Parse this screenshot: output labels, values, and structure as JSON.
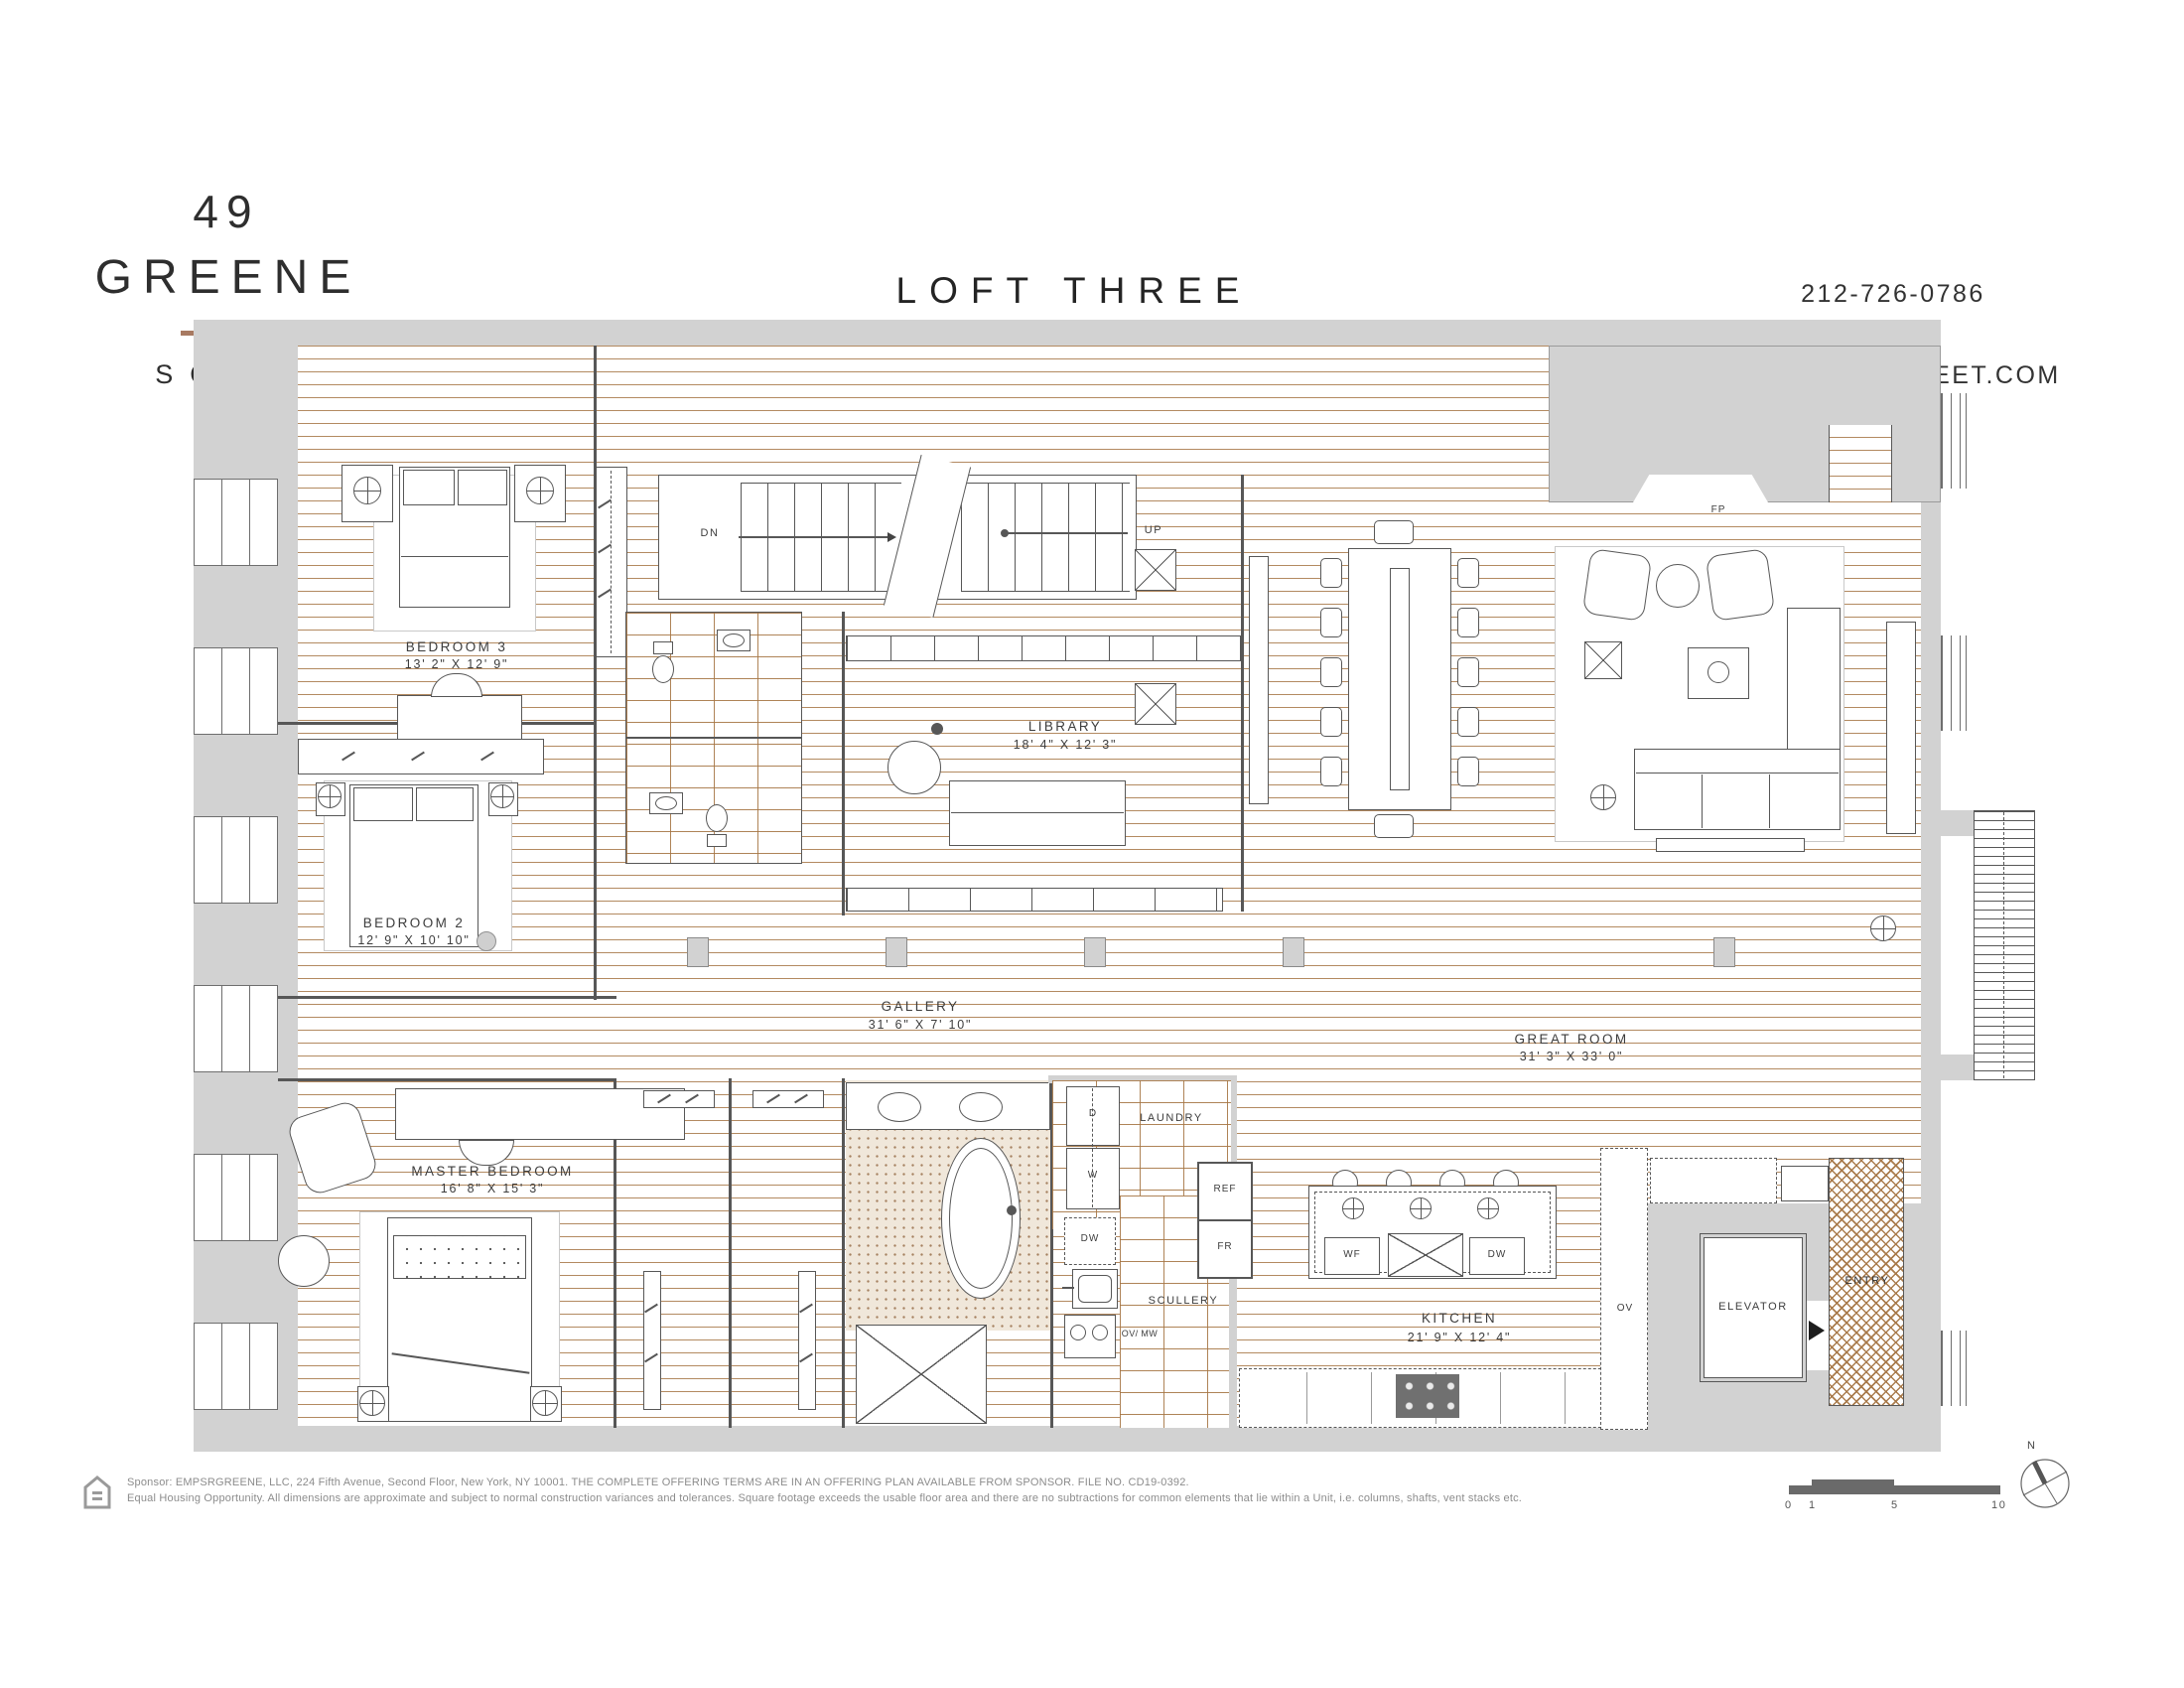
{
  "header": {
    "logo_number": "49",
    "logo_name": "GREENE",
    "logo_area": "SOHO",
    "title": "LOFT THREE",
    "stat_sf": "3,834 SF",
    "divider": "|",
    "stat_bedrooms": "3 BEDROOMS",
    "stat_baths": "3.5 BATHS",
    "phone": "212-726-0786",
    "website": "49GREENESTREET.COM"
  },
  "rooms": {
    "bedroom3": {
      "name": "BEDROOM 3",
      "dims": "13' 2\" X 12' 9\""
    },
    "bedroom2": {
      "name": "BEDROOM 2",
      "dims": "12' 9\" X 10' 10\""
    },
    "master": {
      "name": "MASTER BEDROOM",
      "dims": "16' 8\" X 15' 3\""
    },
    "library": {
      "name": "LIBRARY",
      "dims": "18' 4\" X 12' 3\""
    },
    "gallery": {
      "name": "GALLERY",
      "dims": "31' 6\" X 7' 10\""
    },
    "great_room": {
      "name": "GREAT ROOM",
      "dims": "31' 3\" X 33' 0\""
    },
    "kitchen": {
      "name": "KITCHEN",
      "dims": "21' 9\" X 12' 4\""
    },
    "laundry": {
      "name": "LAUNDRY"
    },
    "scullery": {
      "name": "SCULLERY"
    },
    "elevator": {
      "name": "ELEVATOR"
    },
    "entry": {
      "name": "ENTRY"
    }
  },
  "plan_labels": {
    "fp": "FP",
    "dn": "DN",
    "up": "UP",
    "d": "D",
    "w": "W",
    "dw": "DW",
    "ref": "REF",
    "fr": "FR",
    "ov_mw": "OV/ MW",
    "wf": "WF",
    "dw_island": "DW",
    "ov": "OV"
  },
  "scale_bar": {
    "t0": "0",
    "t1": "1",
    "t5": "5",
    "t10": "10",
    "north": "N"
  },
  "footer": {
    "line1": "Sponsor: EMPSRGREENE, LLC, 224 Fifth Avenue, Second Floor, New York, NY 10001. THE COMPLETE OFFERING TERMS ARE IN AN OFFERING PLAN AVAILABLE FROM SPONSOR. FILE NO. CD19-0392.",
    "line2": "Equal Housing Opportunity. All dimensions are approximate and subject to normal construction variances and tolerances. Square footage exceeds the usable floor area and there are no subtractions for common elements that lie within a Unit, i.e. columns, shafts, vent stacks etc.",
    "equal_housing_icon": "equal-housing-logo"
  },
  "icons": {
    "lamp": "circle-cross-lamp",
    "compass": "north-compass",
    "elevator_arrow": "solid-right-triangle"
  },
  "colors": {
    "accent": "#ab8672",
    "rule": "#a87a62",
    "wall": "#d2d2d2",
    "plank": "#a97c52",
    "tile": "#b08053"
  }
}
